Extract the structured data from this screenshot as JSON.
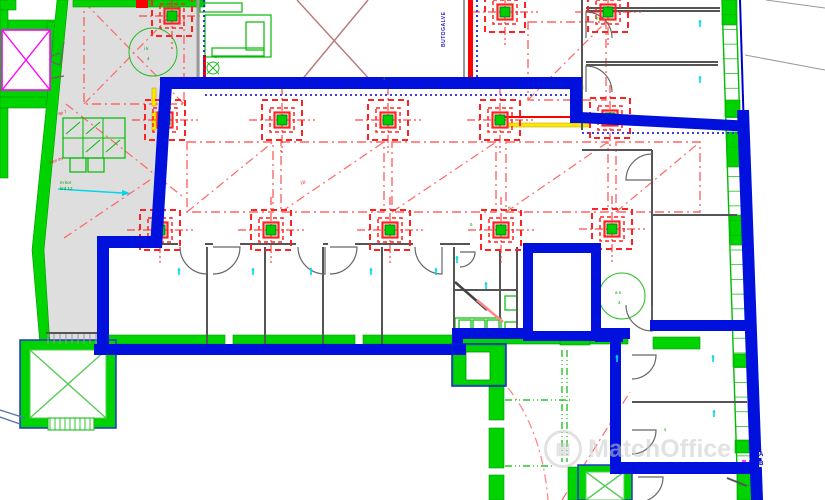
{
  "watermark": {
    "logo_glyph": "▦",
    "text": "MatchOffice"
  },
  "labels": {
    "vertical_blue": "BUTOGALVE",
    "corner_a": "A",
    "corner_b": "B"
  },
  "annotations": {
    "tiny_green": [
      [
        215,
        54,
        "z"
      ],
      [
        383,
        76,
        "4"
      ],
      [
        596,
        16,
        "m"
      ],
      [
        470,
        222,
        "5"
      ],
      [
        664,
        427,
        "s"
      ],
      [
        144,
        46,
        "i k"
      ],
      [
        147,
        56,
        "4"
      ],
      [
        615,
        290,
        "a s"
      ],
      [
        618,
        300,
        "4"
      ],
      [
        508,
        205,
        "e"
      ],
      [
        60,
        180,
        "m kor"
      ],
      [
        60,
        186,
        "krd 12"
      ]
    ],
    "tiny_red": [
      [
        48,
        158,
        "nuor im"
      ],
      [
        300,
        180,
        "1B"
      ],
      [
        58,
        110,
        "ap 7"
      ]
    ]
  },
  "colors": {
    "zone_blue": "#0010dd",
    "wall_green": "#00d400",
    "green_line": "#00bb00",
    "light_green": "#55cc55",
    "column_red": "#ff2222",
    "bay_red": "#ff6666",
    "gray_area": "#d8d8d8",
    "wall_gray": "#555555",
    "cyan": "#00d8e8",
    "magenta": "#ff00ff",
    "yellow": "#ffe800",
    "brown": "#b87878",
    "pink": "#ff8888"
  },
  "plan": {
    "gray_polys": [
      "63,0 200,0 200,86 160,86 153,242 100,242 98,348 44,348 34,255 58,60"
    ],
    "bays": [
      [
        187,
        142,
        86,
        70
      ],
      [
        281,
        142,
        103,
        70
      ],
      [
        392,
        142,
        104,
        70
      ],
      [
        506,
        142,
        102,
        70
      ],
      [
        616,
        142,
        84,
        70
      ],
      [
        84,
        2,
        100,
        102
      ],
      [
        528,
        22,
        78,
        78
      ]
    ],
    "red_dashdot_lines": [
      [
        66,
        104,
        182,
        196
      ],
      [
        64,
        238,
        150,
        180
      ],
      [
        562,
        500,
        630,
        392
      ],
      [
        84,
        2,
        184,
        104
      ]
    ],
    "brown_lines": [
      [
        297,
        0,
        372,
        82
      ],
      [
        368,
        0,
        300,
        82
      ]
    ],
    "yellow_rects": [
      [
        508,
        123,
        82,
        4,
        0
      ],
      [
        550,
        85,
        33,
        4,
        0
      ],
      [
        152,
        88,
        4,
        18,
        0
      ],
      [
        152,
        112,
        4,
        18,
        0
      ],
      [
        102,
        0,
        38,
        7,
        -8
      ]
    ],
    "red_rects": [
      [
        468,
        0,
        5,
        85
      ],
      [
        136,
        0,
        12,
        8
      ],
      [
        203,
        55,
        3,
        31
      ]
    ],
    "red_lines": [
      [
        505,
        117,
        608,
        117
      ]
    ],
    "red_arc": "M508,388 Q542,430 548,500",
    "green_solid": [
      [
        0,
        20,
        60,
        12
      ],
      [
        47,
        22,
        10,
        75
      ],
      [
        0,
        88,
        55,
        10
      ],
      [
        0,
        0,
        16,
        10
      ],
      [
        0,
        10,
        8,
        80
      ],
      [
        0,
        97,
        48,
        11
      ],
      [
        0,
        108,
        8,
        70
      ],
      [
        73,
        0,
        132,
        7
      ],
      [
        100,
        335,
        125,
        9
      ],
      [
        233,
        335,
        122,
        9
      ],
      [
        363,
        335,
        95,
        9
      ],
      [
        453,
        334,
        175,
        10
      ],
      [
        453,
        345,
        52,
        40
      ],
      [
        489,
        385,
        15,
        35
      ],
      [
        489,
        428,
        15,
        40
      ],
      [
        489,
        475,
        15,
        25
      ],
      [
        560,
        333,
        30,
        12
      ],
      [
        653,
        337,
        47,
        12
      ],
      [
        568,
        467,
        10,
        33
      ],
      [
        722,
        0,
        15,
        25
      ],
      [
        725,
        100,
        15,
        17
      ],
      [
        727,
        132,
        15,
        35
      ],
      [
        730,
        215,
        14,
        30
      ],
      [
        733,
        354,
        14,
        13
      ],
      [
        735,
        440,
        14,
        13
      ],
      [
        737,
        470,
        15,
        30
      ]
    ],
    "white_rects": [
      [
        466,
        352,
        24,
        28
      ]
    ],
    "green_outline": [
      [
        63,
        118,
        62,
        40
      ],
      [
        70,
        158,
        16,
        14
      ],
      [
        88,
        158,
        16,
        14
      ],
      [
        200,
        3,
        42,
        9
      ],
      [
        205,
        15,
        66,
        42
      ],
      [
        246,
        22,
        18,
        28
      ],
      [
        212,
        48,
        52,
        8
      ],
      [
        455,
        318,
        46,
        14
      ],
      [
        459,
        320,
        12,
        10
      ],
      [
        473,
        320,
        12,
        10
      ],
      [
        487,
        320,
        12,
        10
      ],
      [
        505,
        322,
        12,
        15
      ],
      [
        505,
        296,
        12,
        14
      ],
      [
        99,
        362,
        5,
        28
      ]
    ],
    "green_wall_polys": [
      "57,0 68,0 44,250 50,345 40,345 32,250"
    ],
    "green_lines": [
      [
        63,
        138,
        125,
        138
      ],
      [
        83,
        118,
        83,
        158
      ],
      [
        103,
        118,
        103,
        158
      ],
      [
        66,
        134,
        80,
        122
      ],
      [
        86,
        134,
        100,
        122
      ],
      [
        86,
        152,
        100,
        140
      ],
      [
        106,
        152,
        120,
        140
      ]
    ],
    "green_dashdot": [
      [
        505,
        400,
        570,
        400
      ],
      [
        562,
        350,
        562,
        462
      ],
      [
        567,
        350,
        567,
        462
      ],
      [
        505,
        466,
        553,
        466
      ]
    ],
    "band": {
      "l1": [
        722,
        0,
        738,
        500
      ],
      "l2": [
        736,
        0,
        752,
        500
      ],
      "ticks": 34
    },
    "elevators": [
      {
        "frame": [
          20,
          340,
          96,
          88
        ],
        "hole": [
          30,
          350,
          76,
          68
        ],
        "x_color": "light"
      },
      {
        "frame": [
          578,
          465,
          54,
          35
        ],
        "hole": [
          586,
          472,
          38,
          28
        ],
        "x_color": "dark"
      }
    ],
    "elevator_x": [
      [
        30,
        350,
        106,
        418
      ],
      [
        106,
        350,
        30,
        418
      ],
      [
        586,
        472,
        624,
        500
      ],
      [
        624,
        472,
        586,
        500
      ]
    ],
    "hatch_window": {
      "x": 48,
      "y": 418,
      "w": 46,
      "h": 12,
      "step": 5
    },
    "stair_treads": {
      "x0": 48,
      "x1": 98,
      "step": 6,
      "y0": 334,
      "y1": 344
    },
    "stair_arrows": [
      [
        0,
        410,
        25,
        418
      ],
      [
        0,
        417,
        20,
        424
      ]
    ],
    "walls": [
      [
        155,
        244,
        178,
        244
      ],
      [
        205,
        244,
        213,
        244
      ],
      [
        240,
        244,
        296,
        244
      ],
      [
        323,
        244,
        328,
        244
      ],
      [
        355,
        244,
        413,
        244
      ],
      [
        440,
        244,
        470,
        244
      ],
      [
        207,
        247,
        207,
        344
      ],
      [
        265,
        247,
        265,
        344
      ],
      [
        323,
        247,
        323,
        344
      ],
      [
        382,
        247,
        382,
        344
      ],
      [
        454,
        247,
        454,
        332
      ],
      [
        500,
        250,
        500,
        318
      ],
      [
        517,
        247,
        517,
        332
      ],
      [
        454,
        290,
        517,
        290
      ],
      [
        582,
        0,
        582,
        130
      ],
      [
        586,
        8,
        720,
        8
      ],
      [
        586,
        11,
        720,
        11
      ],
      [
        586,
        62,
        718,
        62
      ],
      [
        586,
        65,
        718,
        65
      ],
      [
        582,
        150,
        652,
        150
      ],
      [
        652,
        150,
        652,
        320
      ],
      [
        652,
        215,
        737,
        215
      ],
      [
        632,
        402,
        747,
        402
      ],
      [
        46,
        333,
        100,
        333
      ],
      [
        727,
        478,
        747,
        486
      ]
    ],
    "wall_diag": [
      [
        455,
        282,
        487,
        310
      ]
    ],
    "pink_lines": [
      [
        477,
        300,
        503,
        322
      ]
    ],
    "doors": [
      {
        "c": [
          207,
          247
        ],
        "r": 27,
        "a0": 90,
        "a1": 180
      },
      {
        "c": [
          213,
          247
        ],
        "r": 27,
        "a0": 0,
        "a1": 90
      },
      {
        "c": [
          325,
          247
        ],
        "r": 27,
        "a0": 90,
        "a1": 180
      },
      {
        "c": [
          330,
          247
        ],
        "r": 27,
        "a0": 0,
        "a1": 90
      },
      {
        "c": [
          442,
          247
        ],
        "r": 27,
        "a0": 90,
        "a1": 180
      },
      {
        "c": [
          586,
          38
        ],
        "r": 26,
        "a0": -90,
        "a1": 0
      },
      {
        "c": [
          586,
          92
        ],
        "r": 26,
        "a0": -90,
        "a1": 0
      },
      {
        "c": [
          652,
          180
        ],
        "r": 26,
        "a0": 180,
        "a1": 270
      },
      {
        "c": [
          652,
          305
        ],
        "r": 26,
        "a0": 90,
        "a1": 180
      },
      {
        "c": [
          632,
          355
        ],
        "r": 24,
        "a0": 0,
        "a1": 90
      },
      {
        "c": [
          632,
          430
        ],
        "r": 24,
        "a0": 0,
        "a1": 90
      },
      {
        "c": [
          638,
          477
        ],
        "r": 25,
        "a0": 0,
        "a1": 90
      },
      {
        "c": [
          64,
          42
        ],
        "r": 23,
        "a0": 100,
        "a1": 190
      },
      {
        "c": [
          64,
          76
        ],
        "r": 23,
        "a0": 170,
        "a1": 260
      },
      {
        "c": [
          460,
          252
        ],
        "r": 15,
        "a0": 0,
        "a1": 90
      }
    ],
    "columns": [
      [
        172,
        16
      ],
      [
        505,
        12
      ],
      [
        608,
        12
      ],
      [
        165,
        120
      ],
      [
        282,
        120
      ],
      [
        388,
        120
      ],
      [
        500,
        120
      ],
      [
        610,
        118
      ],
      [
        160,
        230
      ],
      [
        271,
        230
      ],
      [
        390,
        230
      ],
      [
        501,
        230
      ],
      [
        612,
        229
      ]
    ],
    "circles": [
      [
        153,
        52,
        24
      ],
      [
        622,
        296,
        23
      ],
      [
        213,
        68,
        6
      ]
    ],
    "circle_x": [
      [
        207,
        62,
        219,
        74
      ],
      [
        219,
        62,
        207,
        74
      ]
    ],
    "magenta_box": [
      2,
      30,
      48,
      60
    ],
    "magenta_lines": [
      [
        2,
        30,
        50,
        90
      ],
      [
        50,
        30,
        2,
        90
      ]
    ],
    "magenta_dash": [
      [
        742,
        461,
        763,
        461
      ]
    ],
    "gray_lines": [
      [
        198,
        0,
        198,
        86,
        3
      ],
      [
        464,
        0,
        464,
        85,
        2
      ],
      [
        745,
        55,
        825,
        70,
        1
      ],
      [
        766,
        0,
        825,
        8,
        1
      ]
    ],
    "blue_dotted": [
      [
        205,
        95,
        578,
        95
      ],
      [
        582,
        133,
        745,
        133
      ],
      [
        204,
        0,
        204,
        88
      ],
      [
        477,
        0,
        477,
        85
      ]
    ],
    "blue_thin_lines": [
      [
        740,
        0,
        750,
        330
      ]
    ],
    "blue_rects": [
      [
        160,
        77,
        422,
        12,
        0
      ],
      [
        570,
        77,
        12,
        46,
        0
      ],
      [
        580,
        112,
        168,
        11,
        3
      ],
      [
        97,
        236,
        65,
        12,
        0
      ],
      [
        97,
        236,
        12,
        112,
        0
      ],
      [
        94,
        344,
        372,
        11,
        0
      ],
      [
        452,
        331,
        11,
        24,
        0
      ],
      [
        452,
        328,
        178,
        11,
        0
      ],
      [
        595,
        332,
        28,
        10,
        0
      ],
      [
        610,
        338,
        11,
        132,
        0
      ],
      [
        610,
        462,
        142,
        12,
        0
      ],
      [
        550,
        322,
        45,
        10,
        0
      ],
      [
        650,
        320,
        97,
        11,
        0
      ]
    ],
    "blue_polys": [
      "737,110 749,110 763,500 751,500",
      "160,85 172,85 162,248 150,248"
    ],
    "blue_rect_outline": [
      [
        528,
        248,
        68,
        88
      ]
    ],
    "blue_thin_rect_outline": [
      [
        452,
        344,
        54,
        42
      ]
    ],
    "cyan_ticks": [
      [
        179,
        268
      ],
      [
        253,
        268
      ],
      [
        311,
        268
      ],
      [
        371,
        268
      ],
      [
        436,
        268
      ],
      [
        457,
        256
      ],
      [
        700,
        20
      ],
      [
        700,
        76
      ],
      [
        713,
        355
      ],
      [
        714,
        410
      ],
      [
        617,
        355
      ],
      [
        486,
        282
      ]
    ],
    "cyan_arrow": [
      58,
      189,
      122,
      193
    ]
  }
}
